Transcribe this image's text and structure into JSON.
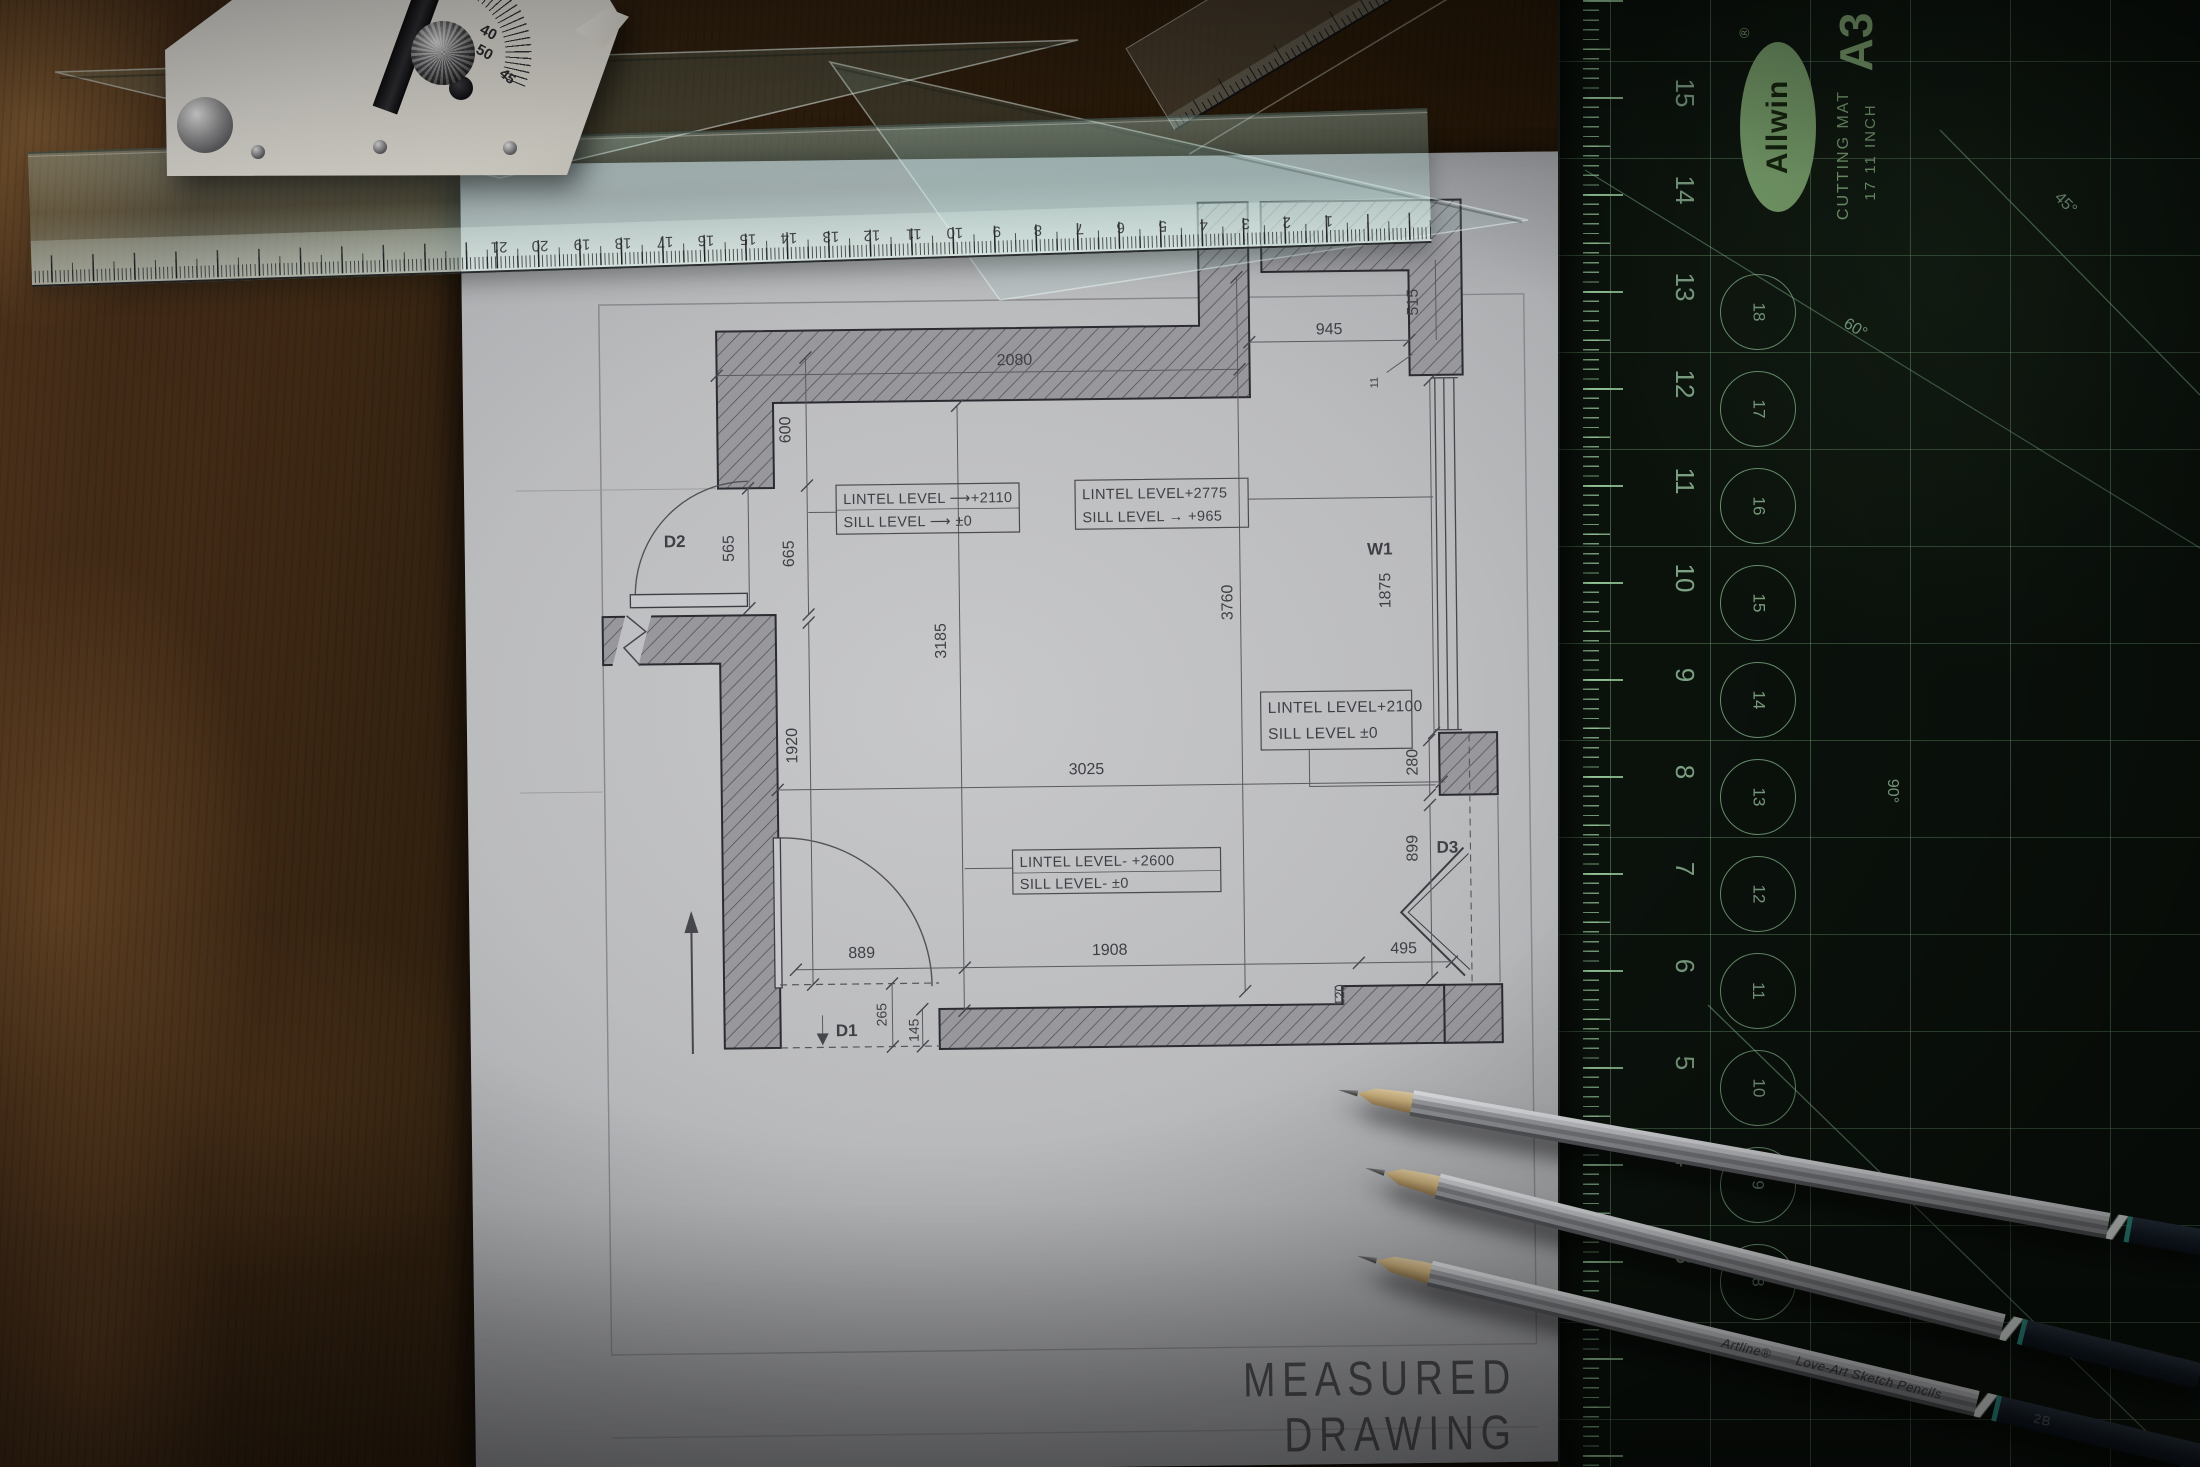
{
  "drawing": {
    "title": "MEASURED DRAWING",
    "labels": {
      "d1": "D1",
      "d2": "D2",
      "d3": "D3",
      "w1": "W1"
    },
    "dims": {
      "w2080": "2080",
      "w945": "945",
      "w515": "515",
      "w11": "11",
      "h600": "600",
      "h565": "565",
      "h665": "665",
      "h1920": "1920",
      "h3185": "3185",
      "h3760": "3760",
      "h1875": "1875",
      "w3025": "3025",
      "h280": "280",
      "h899": "899",
      "w889": "889",
      "w1908": "1908",
      "w495": "495",
      "h265": "265",
      "h145": "145",
      "h120": "120"
    },
    "notes": {
      "box1_l1": "LINTEL LEVEL ⟶+2110",
      "box1_l2": "SILL LEVEL ⟶ ±0",
      "box2_l1": "LINTEL LEVEL+2775",
      "box2_l2": "SILL LEVEL → +965",
      "box3_l1": "LINTEL LEVEL+2100",
      "box3_l2": "SILL LEVEL ±0",
      "box4_l1": "LINTEL LEVEL- +2600",
      "box4_l2": "SILL LEVEL- ±0"
    }
  },
  "mat": {
    "brand": "Allwin",
    "registered": "®",
    "size": "A3",
    "type_label": "CUTTING MAT",
    "spec_label": "17  11 INCH",
    "edge_numbers": [
      "15",
      "14",
      "13",
      "12",
      "11",
      "10",
      "9",
      "8",
      "7",
      "6",
      "5",
      "4",
      "3"
    ],
    "circle_numbers": [
      "18",
      "17",
      "16",
      "15",
      "14",
      "13",
      "12",
      "11",
      "10",
      "9",
      "8"
    ],
    "angles": {
      "a45": "45°",
      "a60": "60°",
      "a90": "90°"
    },
    "colors": {
      "surface": "#0b120c",
      "print": "#7da183",
      "logo": "#7ea771"
    }
  },
  "scale_ruler": {
    "numbers": [
      "21",
      "20",
      "19",
      "18",
      "17",
      "16",
      "15",
      "14",
      "13",
      "12",
      "11",
      "10",
      "9",
      "8",
      "7",
      "6",
      "5",
      "4",
      "3",
      "2",
      "1"
    ]
  },
  "protractor": {
    "n40": "40",
    "n50": "50",
    "n45": "45"
  },
  "pencils": {
    "brand": "Artline®",
    "line": "Love-Art Sketch Pencils",
    "grade": "2B"
  }
}
